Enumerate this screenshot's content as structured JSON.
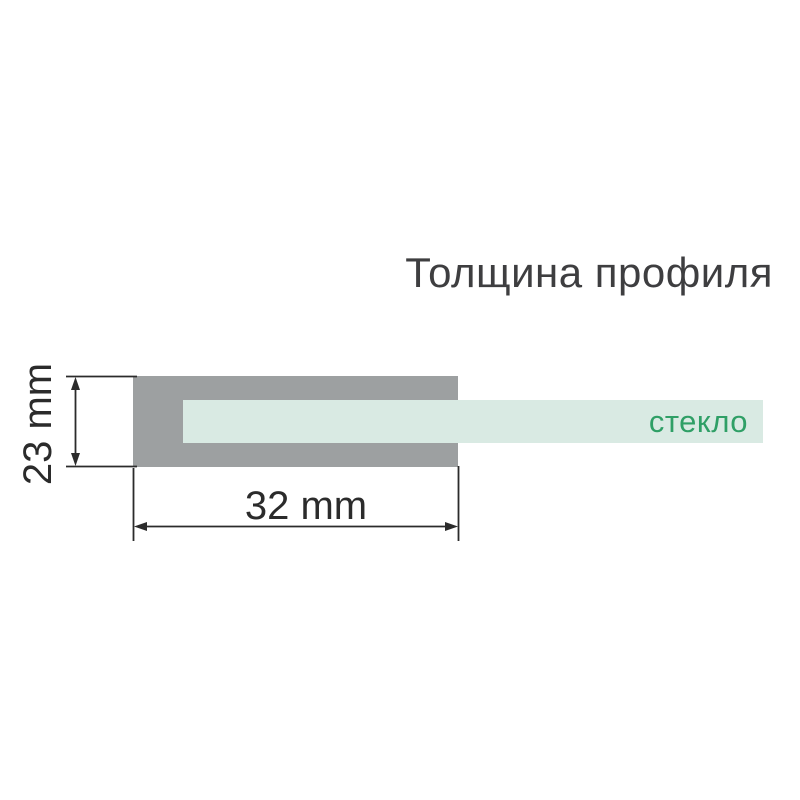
{
  "title": "Толщина профиля",
  "diagram": {
    "glass_label": "стекло",
    "height_dimension": "23 mm",
    "width_dimension": "32 mm"
  },
  "colors": {
    "profile_gray": "#9da0a1",
    "glass_mint": "#d9eae3",
    "glass_label_green": "#2f9f66",
    "dimension_line_dark": "#2b2b2b",
    "title_text": "#3e3e40",
    "background": "#ffffff"
  }
}
